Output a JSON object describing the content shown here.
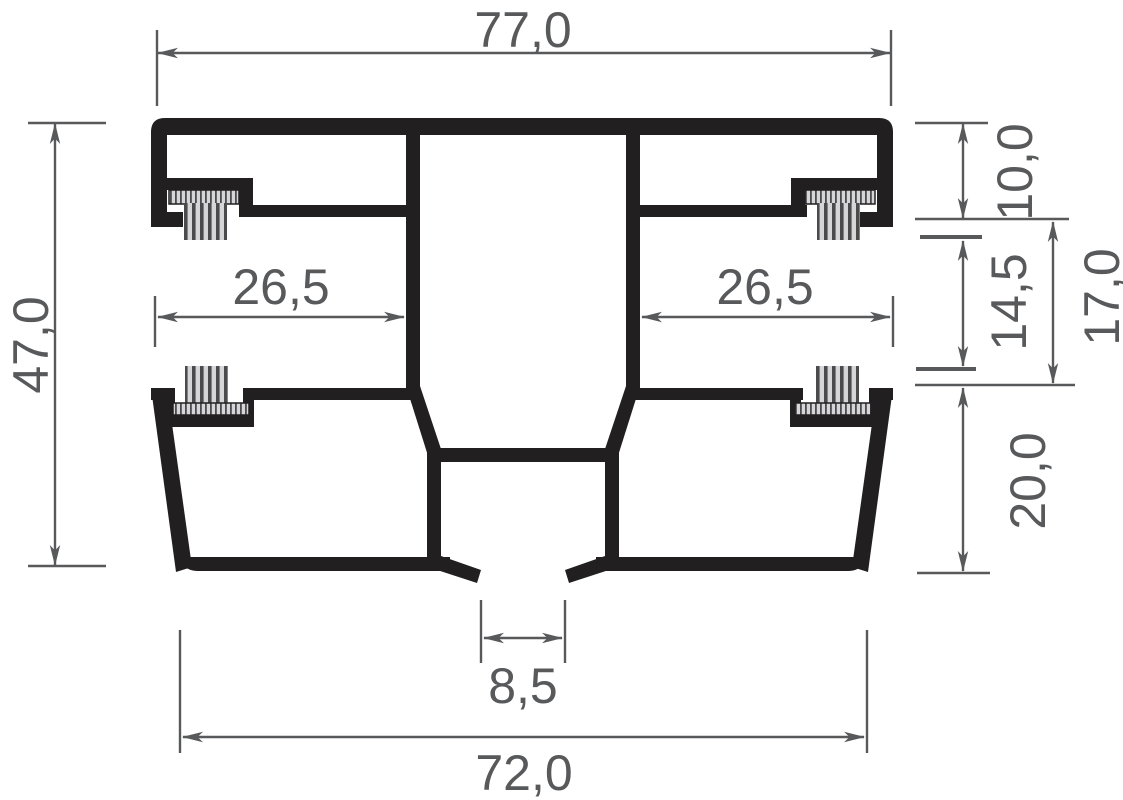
{
  "colors": {
    "background": "#ffffff",
    "profile_ink": "#221f20",
    "dimension_gray": "#58595b",
    "brush_light": "#d6d6d8",
    "brush_dark": "#4b4b4e"
  },
  "dimensions": {
    "overall_width": "77,0",
    "overall_height": "47,0",
    "left_groove_width": "26,5",
    "right_groove_width": "26,5",
    "top_chamber_height": "10,0",
    "pile_gap": "14,5",
    "mid_section_height": "17,0",
    "bottom_chamber_height": "20,0",
    "foot_gap": "8,5",
    "bottom_width": "72,0"
  }
}
